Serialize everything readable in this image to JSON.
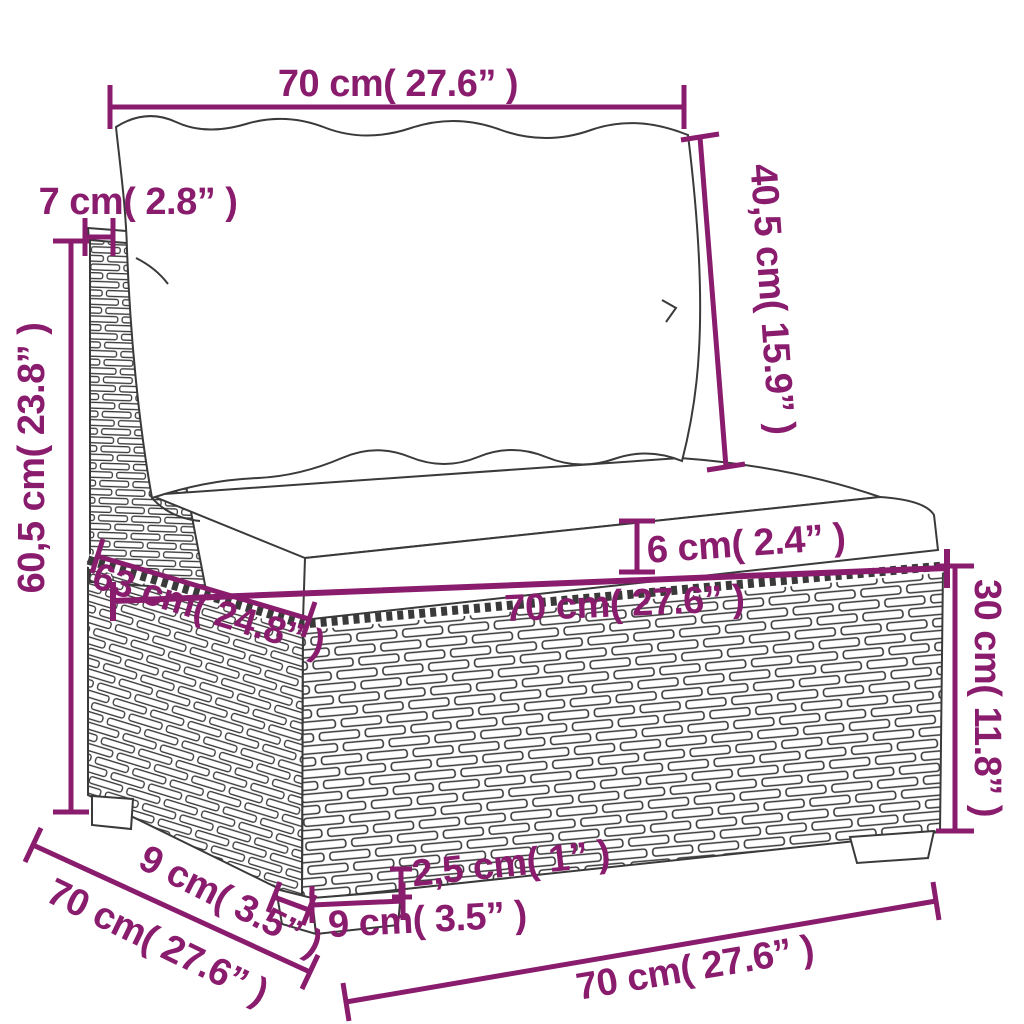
{
  "figure": {
    "kind": "product-dimension-diagram",
    "subject": "rattan garden sofa middle section with back cushion and seat cushion"
  },
  "colors": {
    "dimension_accent": "#8a1c6e",
    "outline": "#3a3a3a",
    "background": "#ffffff",
    "cushion_fill": "#ffffff"
  },
  "dimensions": {
    "top_width": "70 cm( 27.6” )",
    "back_post_width": "7 cm( 2.8” )",
    "back_cushion_height": "40,5 cm( 15.9” )",
    "total_height": "60,5 cm( 23.8” )",
    "seat_cushion_thickness": "6 cm( 2.4” )",
    "seat_width": "70 cm( 27.6” )",
    "seat_depth": "63 cm( 24.8” )",
    "base_height": "30 cm( 11.8” )",
    "leg_depth": "9 cm( 3.5” )",
    "floor_depth": "70 cm( 27.6” )",
    "leg_height": "2,5 cm( 1” )",
    "leg_width": "9 cm( 3.5” )",
    "floor_width": "70 cm( 27.6” )"
  }
}
